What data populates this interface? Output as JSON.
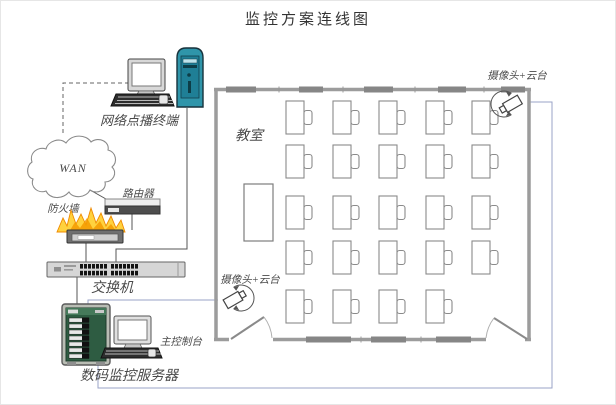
{
  "title": "监控方案连线图",
  "network": {
    "vod_terminal_label": "网络点播终端",
    "wan_label": "WAN",
    "router_label": "路由器",
    "firewall_label": "防火墙",
    "switch_label": "交换机",
    "dvr_server_label": "数码监控服务器",
    "console_label": "主控制台"
  },
  "classroom": {
    "room_label": "教室",
    "camera_top_right_label": "摄像头+云台",
    "camera_bottom_left_label": "摄像头+云台",
    "desk_grid": {
      "cols": [
        285,
        332,
        378,
        425,
        471
      ],
      "rows": [
        100,
        144,
        195,
        240,
        289
      ],
      "desk_w": 18,
      "desk_h": 33,
      "chair_w": 8,
      "chair_h": 14,
      "missing": [
        [
          4,
          4
        ]
      ]
    }
  },
  "colors": {
    "tower-teal": "#2f95aa",
    "flame-yellow": "#ffd23e",
    "flame-orange": "#ef8a00",
    "rack-green": "#2e5c42",
    "wall-gray": "#9c9c9c",
    "cable-dark": "#555555",
    "cable-camera": "#9aa3c7",
    "label-color": "#4a4a4a"
  }
}
